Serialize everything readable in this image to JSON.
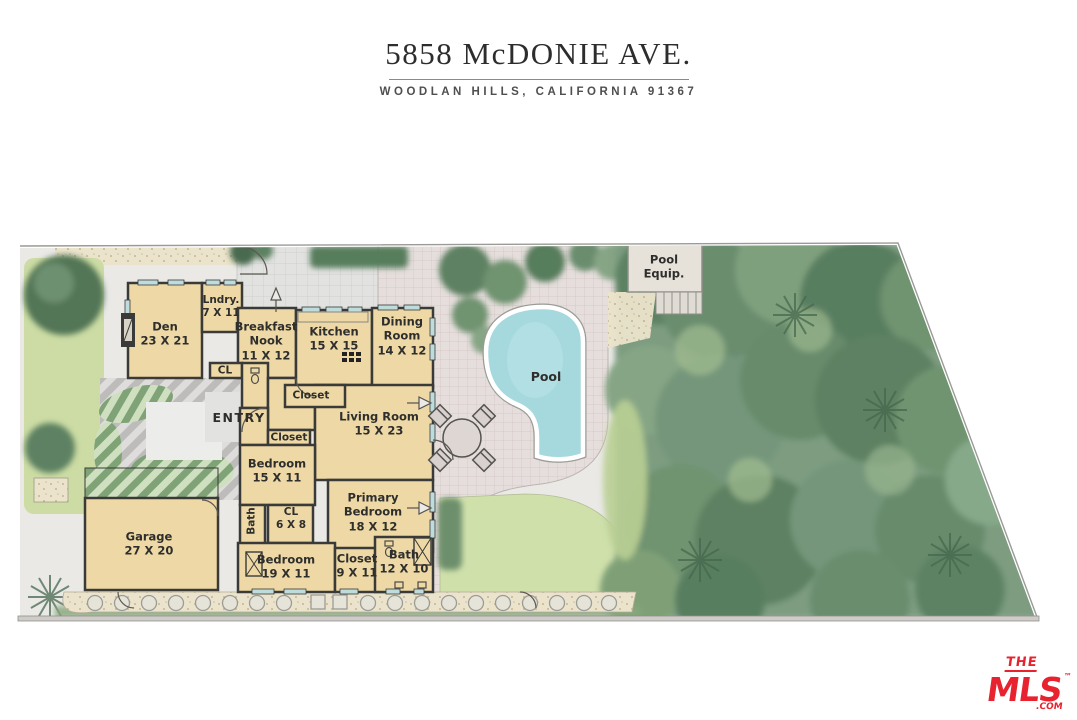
{
  "header": {
    "address": "5858 McDONIE AVE.",
    "location": "WOODLAN HILLS, CALIFORNIA  91367"
  },
  "floorplan": {
    "rooms": [
      {
        "name": "Den",
        "dims": "23 X 21"
      },
      {
        "name": "Lndry.",
        "dims": "7 X 11"
      },
      {
        "name": "Breakfast Nook",
        "dims": "11 X 12"
      },
      {
        "name": "Kitchen",
        "dims": "15 X 15"
      },
      {
        "name": "Dining Room",
        "dims": "14 X 12"
      },
      {
        "name": "Closet",
        "dims": ""
      },
      {
        "name": "Living Room",
        "dims": "15 X 23"
      },
      {
        "name": "ENTRY",
        "dims": ""
      },
      {
        "name": "Closet",
        "dims": ""
      },
      {
        "name": "Bedroom",
        "dims": "15 X 11"
      },
      {
        "name": "CL",
        "dims": ""
      },
      {
        "name": "Bath",
        "dims": ""
      },
      {
        "name": "CL",
        "dims": "6 X 8"
      },
      {
        "name": "Primary Bedroom",
        "dims": "18 X 12"
      },
      {
        "name": "Bedroom",
        "dims": "19 X 11"
      },
      {
        "name": "Closet",
        "dims": "9 X 11"
      },
      {
        "name": "Bath",
        "dims": "12 X 10"
      },
      {
        "name": "Garage",
        "dims": "27 X 20"
      },
      {
        "name": "Pool",
        "dims": ""
      },
      {
        "name": "Pool Equip.",
        "dims": ""
      }
    ]
  },
  "logo": {
    "the": "THE",
    "mls": "MLS",
    "tm": "™",
    "com": ".COM"
  },
  "colors": {
    "logo_red": "#e8232f",
    "room_fill": "#eed9a6",
    "wall": "#3a3a38",
    "pool_water": "#a5d9de",
    "canopy_green": "#6a8d6e",
    "lawn_green": "#ccdca4",
    "patio_pink": "#e6dedc"
  }
}
